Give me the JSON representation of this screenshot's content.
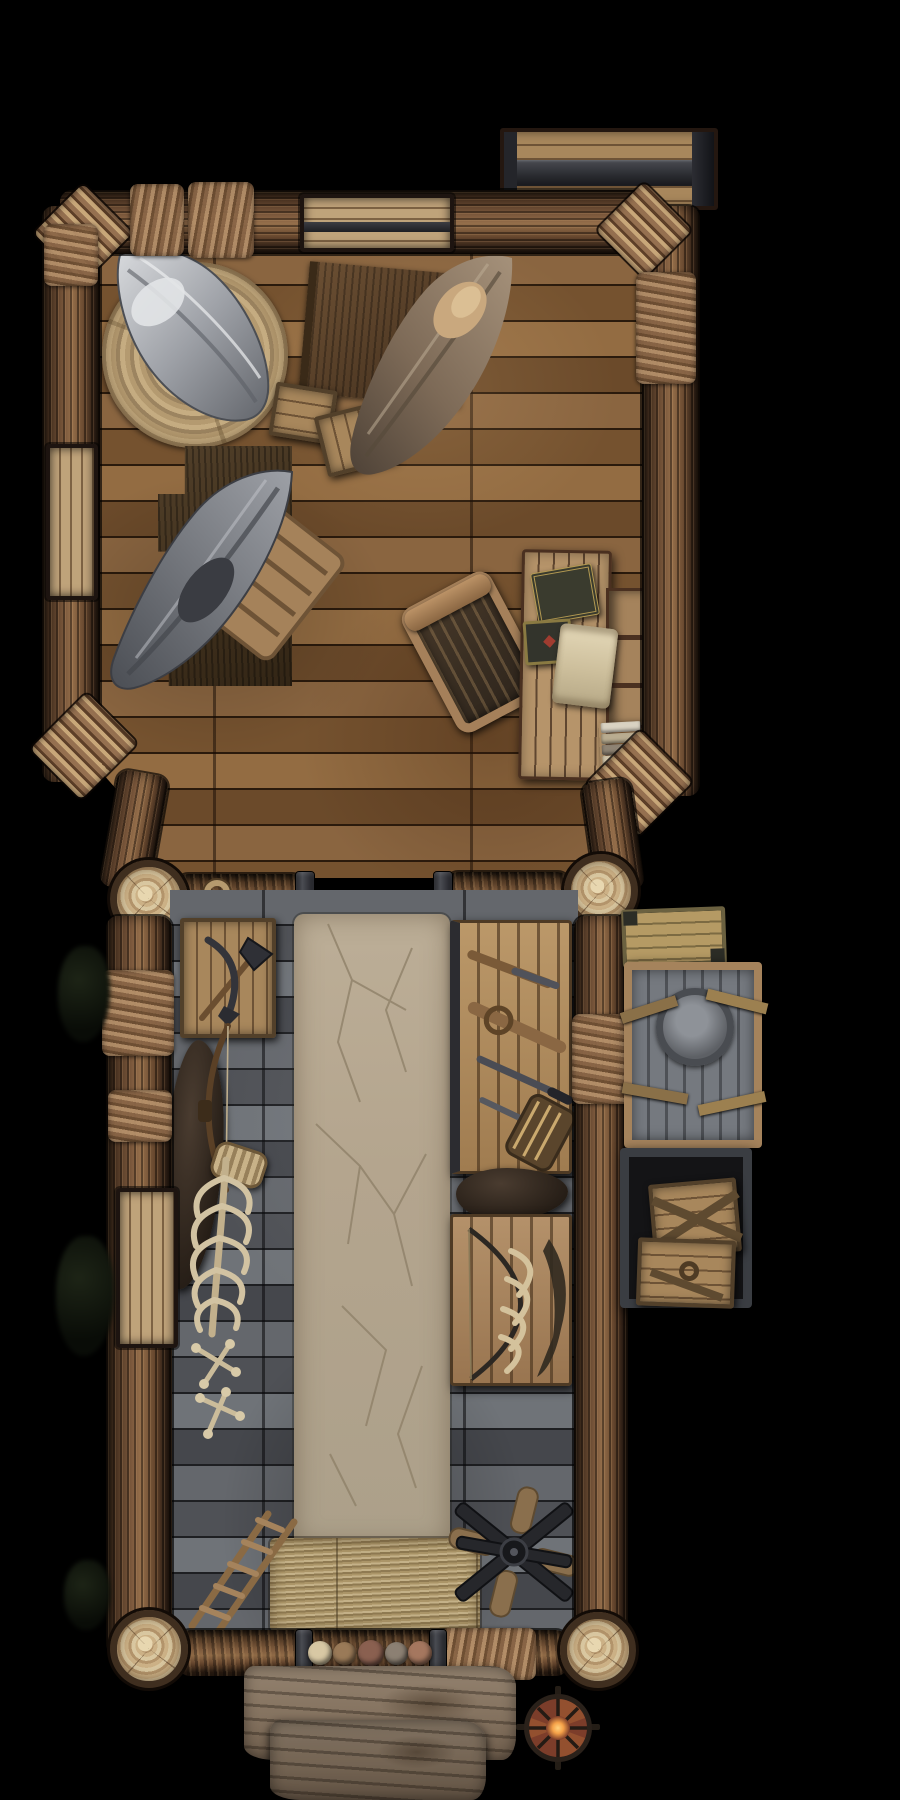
{
  "meta": {
    "kind": "top-down fantasy battlemap",
    "subject": "timber hunters' lodge with bunk room and long hall",
    "background": "#000000",
    "grid_visible": false,
    "text_visible": false
  },
  "palette": {
    "bg": "#000000",
    "barkDark": "#241710",
    "barkMid": "#6b4c34",
    "barkLight": "#a87f58",
    "barkHi": "#cfa678",
    "floorWarm": "#8a6540",
    "floorWarmDark": "#6b4a2a",
    "floorSeam": "#2a1a0c",
    "floorGray": "#64676c",
    "floorGrayDark": "#45474c",
    "floorGraySeam": "#1e1f22",
    "clayPath": "#b4a58e",
    "clayCrack": "#8f8169",
    "logEnd": "#d9c7a0",
    "logEndRing": "#b3946b",
    "logEndEdge": "#3f2e1f",
    "straw": "#b7a277",
    "strawDark": "#8f7a52",
    "canvasGrayLight": "#cfd1d5",
    "canvasGray": "#8b8e94",
    "canvasGrayDark": "#5f6268",
    "canvasBrown": "#8e7a64",
    "pillowTan": "#c9a87e",
    "rugDark": "#43331f",
    "roundRug": "#c0a87e",
    "deskWood": "#b08c62",
    "tableWood": "#ad8a5e",
    "metalDark": "#3a3b40",
    "leather": "#8a7048",
    "bone": "#d2c3a2",
    "crateTan": "#a8875c",
    "crateGray": "#70747a",
    "crateOlive": "#9a8a5a",
    "shieldRed": "#7c3d2a",
    "lanternGlow": "#f5a148",
    "porchWood": "#85735f",
    "peltDark": "#352b22"
  },
  "rooms": [
    {
      "id": "bunk-room",
      "label": "bunk room (upper)",
      "floor": "warm brown plank floor",
      "contents": [
        "gray hammock",
        "round straw rug",
        "brown hammock",
        "fringed mat",
        "supply crates",
        "dark fur rug",
        "second gray hammock with frame",
        "wooden chair",
        "writing desk",
        "two books",
        "parchment scroll",
        "book stack",
        "top wall shelf",
        "left wall shelf"
      ]
    },
    {
      "id": "main-hall",
      "label": "main hall (lower)",
      "floor": "weathered gray planks with cracked clay path",
      "contents": [
        "axe crate",
        "hunting bow",
        "rib cage",
        "bone pile",
        "broken ladder",
        "straw mat",
        "upper weapon table",
        "lower bone table",
        "fur pelts",
        "fallen fan rotor",
        "left wall shelf"
      ]
    },
    {
      "id": "exterior",
      "label": "exterior",
      "contents": [
        "iron-banded storage crate (top)",
        "strapped olive crate",
        "gray emblem crate",
        "crate pallet with two boxes",
        "porch steps",
        "round shield lantern",
        "dark bushes"
      ]
    }
  ],
  "counts": {
    "hammocks": 3,
    "weapon_tables": 2,
    "corner_log_posts": 4,
    "doorway_stepping_stones": 6,
    "entry_stones": 5,
    "book_stack_books": 5,
    "exterior_crates": 4
  }
}
